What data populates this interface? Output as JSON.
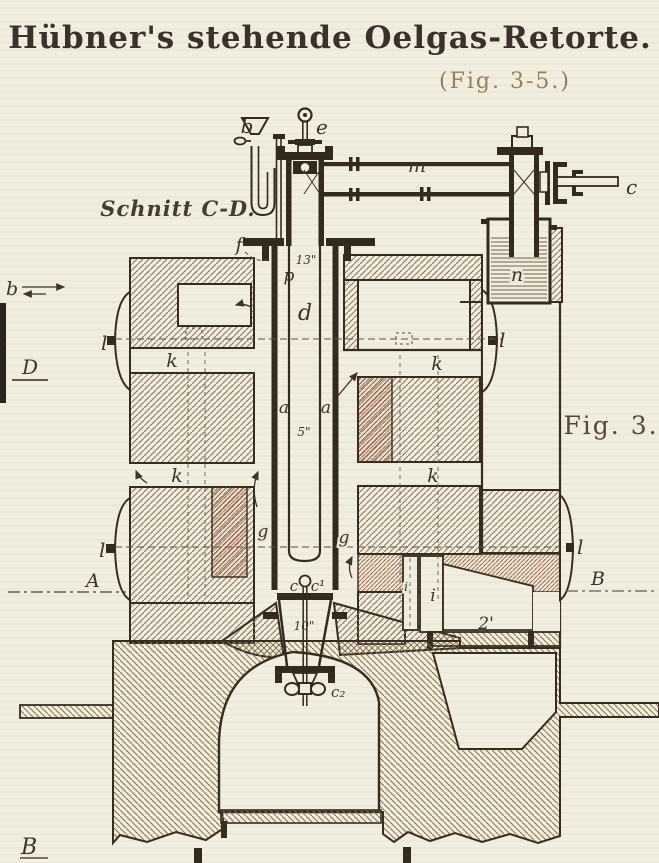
{
  "title": "Hübner's stehende Oelgas-Retorte.",
  "subtitle": "(Fig. 3-5.)",
  "section_label": "Schnitt C-D.",
  "figure_label": "Fig. 3.",
  "colors": {
    "paper": "#f1eddf",
    "ink": "#332a1e",
    "masonry_hatch": "#8c7155",
    "firebrick_hatch": "#9c5f45",
    "subtitle_ink": "#97805e",
    "water": "#73634d"
  },
  "part_labels": {
    "funnel_b": "b",
    "flow_b": "b",
    "valve_e": "e",
    "pipe_m": "m",
    "valve_c": "c",
    "seal_pot_n": "n",
    "flange_f": "f",
    "feed_p": "p",
    "tube_d": "d",
    "annulus_a_left": "a",
    "annulus_a_right": "a",
    "dim_13": "13\"",
    "dim_5": "5\"",
    "dim_10": "10\"",
    "k_left_upper": "k",
    "k_left_lower": "k",
    "k_right_upper": "k",
    "k_right_lower": "k",
    "l_left_upper": "l",
    "l_left_lower": "l",
    "l_right_upper": "l",
    "l_right_lower": "l",
    "g_left": "g",
    "g_right": "g",
    "i_left": "i",
    "i_right": "i",
    "valve_c_bottom": "c",
    "valve_c1": "c¹",
    "screw_c2": "c₂",
    "dim_2ft": "2'",
    "sec_D": "D",
    "sec_A": "A",
    "sec_B": "B",
    "sec_B_bottom": "B"
  }
}
